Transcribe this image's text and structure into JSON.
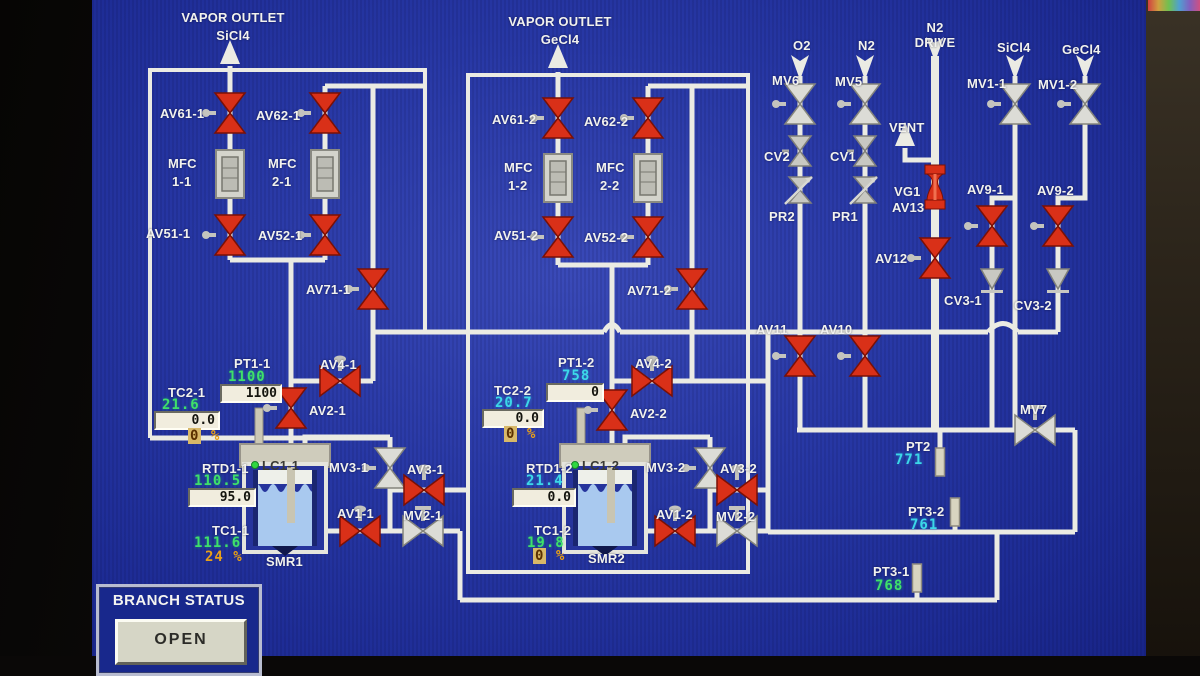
{
  "outlets": {
    "left_title": "VAPOR OUTLET",
    "left_gas": "SiCl4",
    "right_title": "VAPOR OUTLET",
    "right_gas": "GeCl4"
  },
  "feeds": {
    "o2": "O2",
    "n2": "N2",
    "n2_drive_1": "N2",
    "n2_drive_2": "DRIVE",
    "sicl4": "SiCl4",
    "gecl4": "GeCl4",
    "vent": "VENT"
  },
  "labels": {
    "av61_1": "AV61-1",
    "av62_1": "AV62-1",
    "av51_1": "AV51-1",
    "av52_1": "AV52-1",
    "av71_1": "AV71-1",
    "av4_1": "AV4-1",
    "av2_1": "AV2-1",
    "mfc": "MFC",
    "mfc11": "1-1",
    "mfc21": "2-1",
    "mfc12": "1-2",
    "mfc22": "2-2",
    "pt1_1": "PT1-1",
    "tc2_1": "TC2-1",
    "rtd1_1": "RTD1-1",
    "tc1_1": "TC1-1",
    "lc1_1": "LC1-1",
    "mv3_1": "MV3-1",
    "av3_1": "AV3-1",
    "av1_1": "AV1-1",
    "mv2_1": "MV2-1",
    "smr1": "SMR1",
    "av61_2": "AV61-2",
    "av62_2": "AV62-2",
    "av51_2": "AV51-2",
    "av52_2": "AV52-2",
    "av71_2": "AV71-2",
    "av4_2": "AV4-2",
    "av2_2": "AV2-2",
    "pt1_2": "PT1-2",
    "tc2_2": "TC2-2",
    "rtd1_2": "RTD1-2",
    "tc1_2": "TC1-2",
    "lc1_2": "LC1-2",
    "mv3_2": "MV3-2",
    "av3_2": "AV3-2",
    "av1_2": "AV1-2",
    "mv2_2": "MV2-2",
    "smr2": "SMR2",
    "mv6": "MV6",
    "mv5": "MV5",
    "mv1_1": "MV1-1",
    "mv1_2": "MV1-2",
    "cv2": "CV2",
    "cv1": "CV1",
    "pr2": "PR2",
    "pr1": "PR1",
    "vg1": "VG1",
    "av13": "AV13",
    "av12": "AV12",
    "av9_1": "AV9-1",
    "av9_2": "AV9-2",
    "cv3_1": "CV3-1",
    "cv3_2": "CV3-2",
    "av11": "AV11",
    "av10": "AV10",
    "mv7": "MV7",
    "pt2": "PT2",
    "pt3_2": "PT3-2",
    "pt3_1": "PT3-1"
  },
  "values": {
    "pt1_1": "1100",
    "pt1_1_box": "1100",
    "tc2_1": "21.6",
    "tc2_1_box": "0.0",
    "tc2_1_pct": "0",
    "pt1_2": "758",
    "pt1_2_box": "0",
    "tc2_2": "20.7",
    "tc2_2_box": "0.0",
    "tc2_2_pct": "0",
    "rtd1_1": "110.5",
    "rtd1_1_box": "95.0",
    "tc1_1": "111.6",
    "tc1_1_pct": "24",
    "rtd1_2": "21.4",
    "rtd1_2_box": "0.0",
    "tc1_2": "19.8",
    "tc1_2_pct": "0",
    "pt2": "771",
    "pt3_2": "761",
    "pt3_1": "768",
    "pct_sign": "%"
  },
  "branch_status": {
    "title": "BRANCH STATUS",
    "button": "OPEN"
  },
  "colors": {
    "screen_bg": "#2737a4",
    "pipe": "#ebebe3",
    "valve_red": "#d93018",
    "valve_white": "#dcdcd6",
    "value_green": "#3fe06a",
    "value_cyan": "#3cd8e8",
    "value_orange": "#e8a018",
    "readout_bg": "#f1edde",
    "button_bg": "#d6d6c6"
  },
  "icons": {
    "valve_red": "pneumatic-valve-bowtie-red",
    "valve_white": "manual-valve-bowtie-gray",
    "check_valve": "check-valve-gray",
    "regulator": "pressure-regulator-arrow",
    "spool": "red-spool-valve",
    "mfc": "mass-flow-controller-box",
    "pt_sensor": "pressure-sensor-bar",
    "arrow_up": "flow-arrow-up",
    "arrow_down": "flow-arrow-down"
  }
}
